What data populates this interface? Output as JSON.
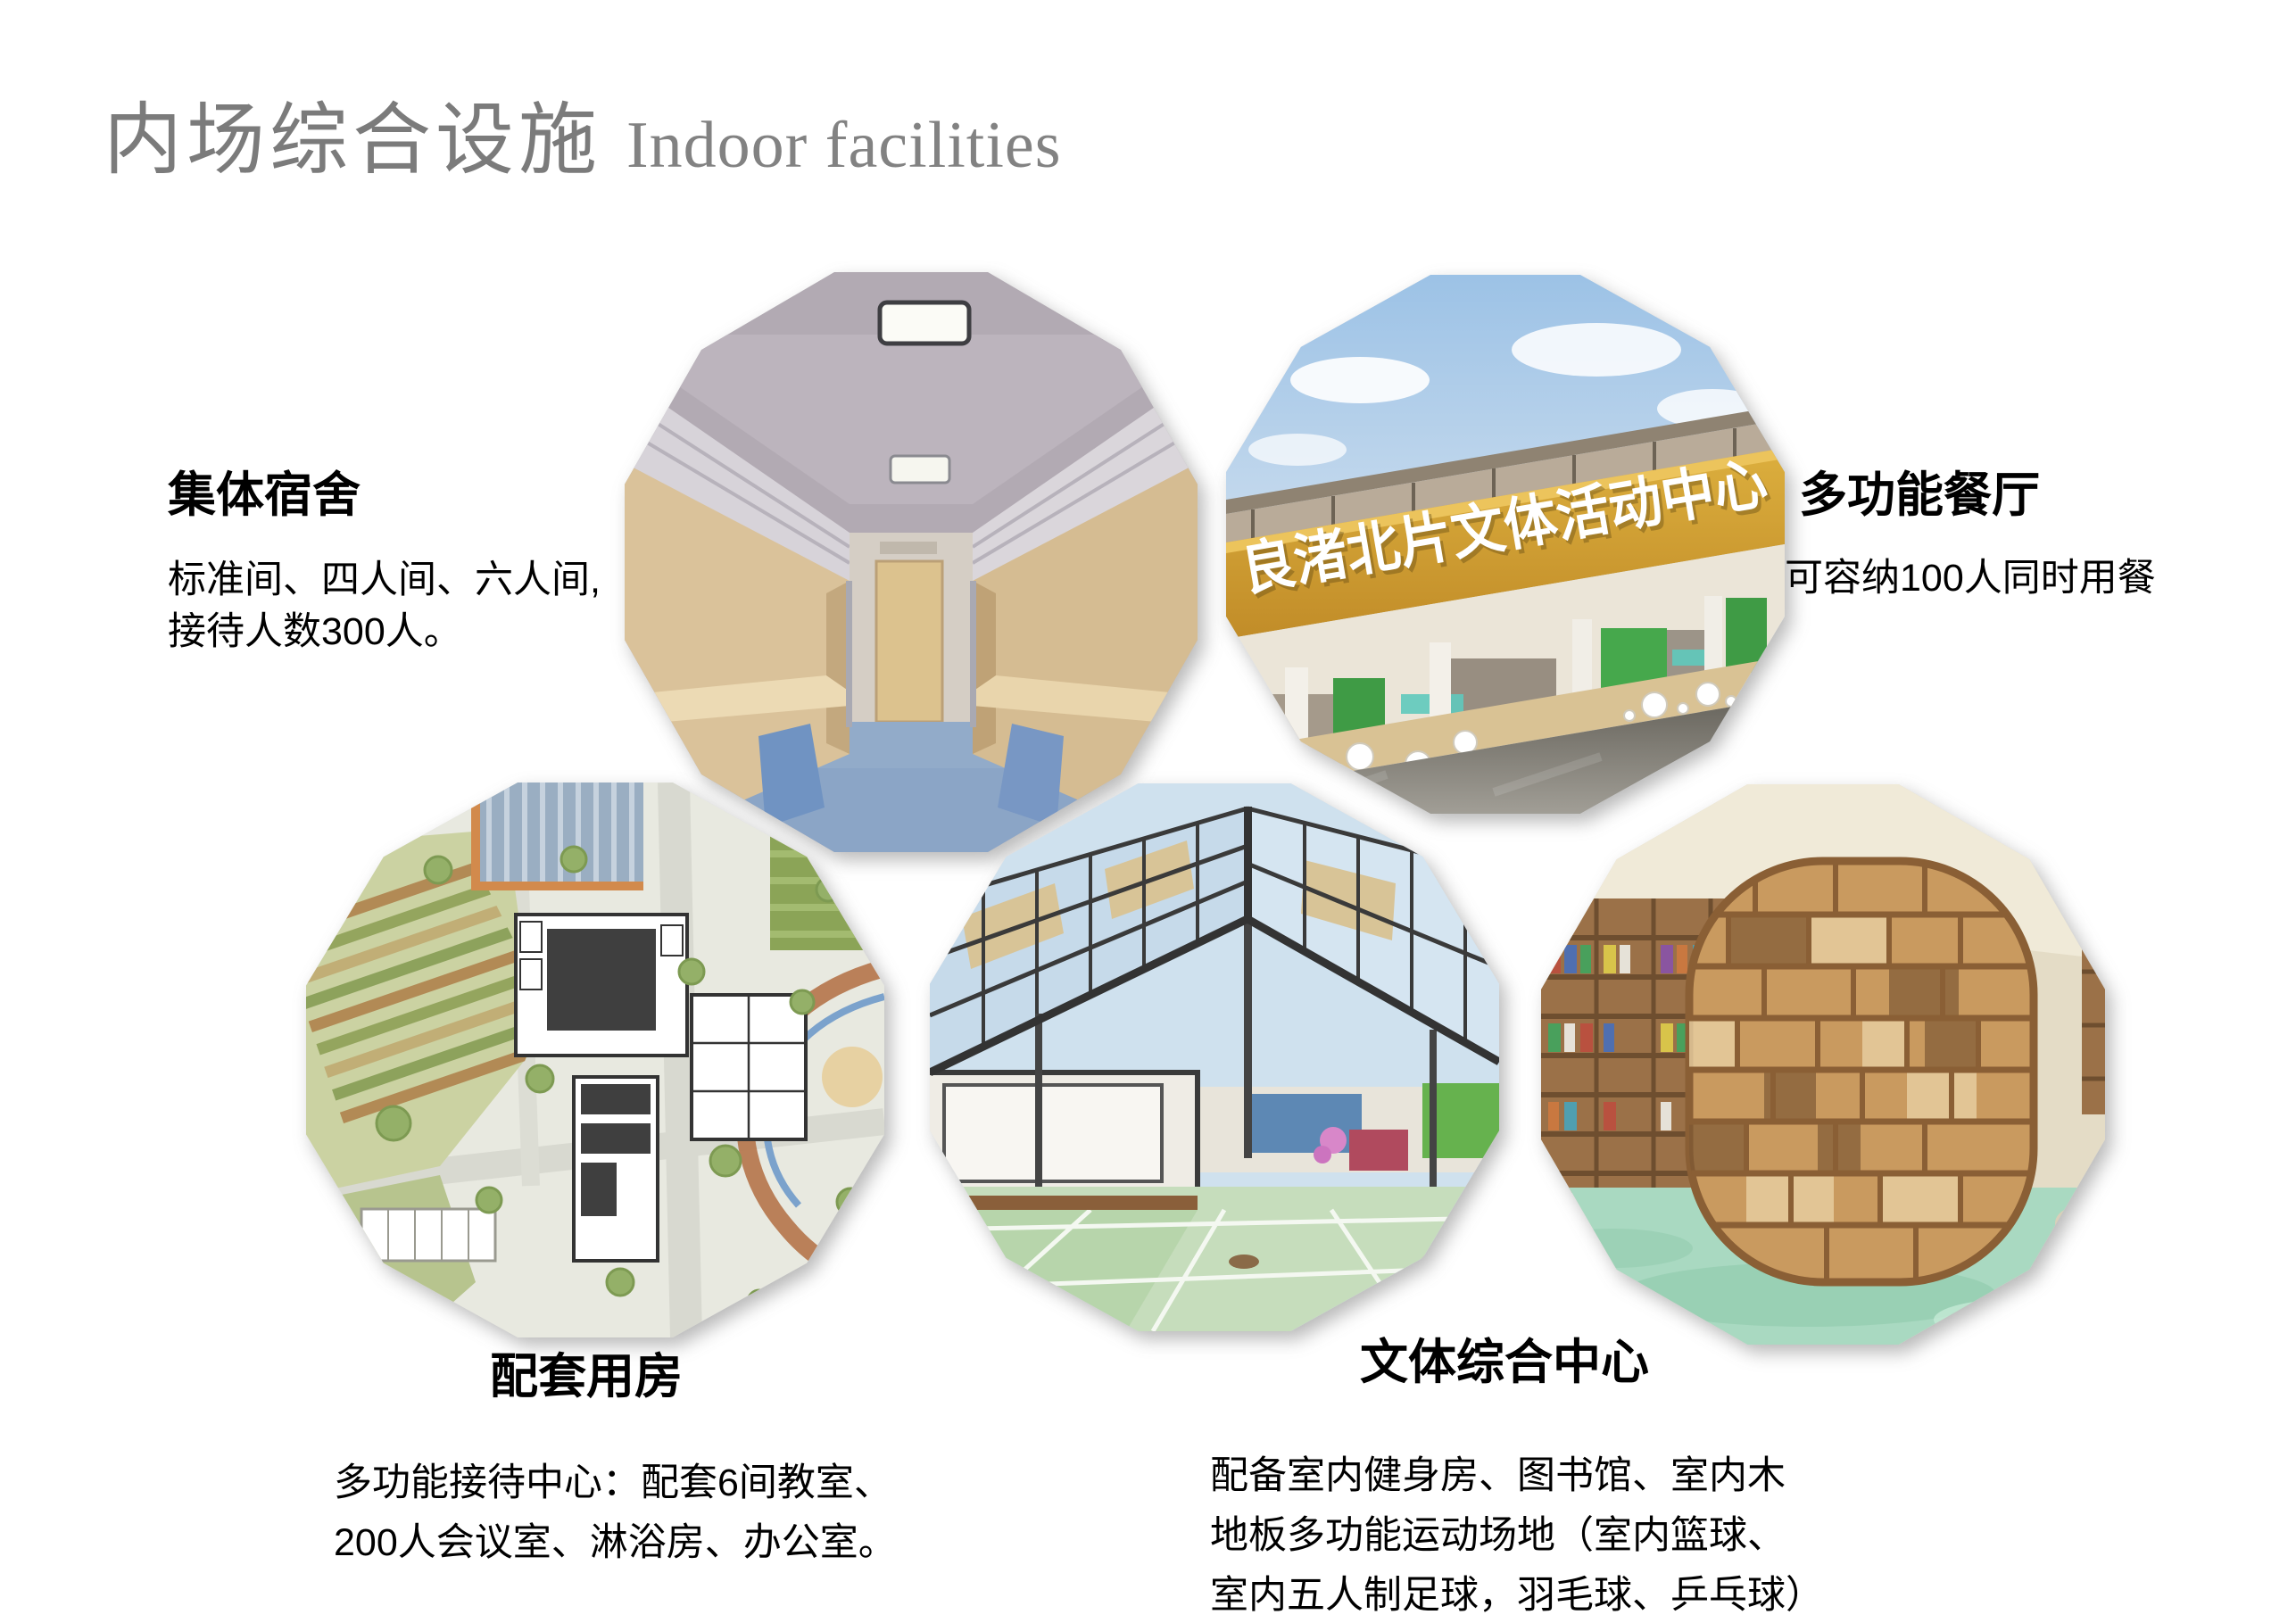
{
  "slide": {
    "title_zh": "内场综合设施",
    "title_en": "Indoor facilities",
    "title_color": "#7b7b7b",
    "background": "#ffffff"
  },
  "facilities": [
    {
      "id": "dormitory",
      "heading": "集体宿舍",
      "lines": [
        "标准间、四人间、六人间,",
        "接待人数300人。"
      ]
    },
    {
      "id": "restaurant",
      "heading": "多功能餐厅",
      "lines": [
        "可容纳100人同时用餐"
      ]
    },
    {
      "id": "support-rooms",
      "heading": "配套用房",
      "lines": [
        "多功能接待中心：配套6间教室、",
        "200人会议室、淋浴房、办公室。"
      ]
    },
    {
      "id": "culture-sports-center",
      "heading": "文体综合中心",
      "lines": [
        "配备室内健身房、图书馆、室内木",
        "地板多功能运动场地（室内篮球、",
        "室内五人制足球，羽毛球、乒乓球）"
      ]
    }
  ],
  "photos": [
    {
      "name": "dormitory-interior-photo"
    },
    {
      "name": "activity-center-photo",
      "sign_text": "良渚北片文体活动中心"
    },
    {
      "name": "site-plan-photo"
    },
    {
      "name": "sports-hall-photo"
    },
    {
      "name": "library-photo"
    }
  ],
  "accent_colors": {
    "sign_gold": "#cf9a2e",
    "dorm_floor_blue": "#8ba5c6",
    "sports_floor_green": "#c6ddbc",
    "library_floor_mint": "#a9d9c1",
    "shelf_wood": "#c99a5f"
  }
}
